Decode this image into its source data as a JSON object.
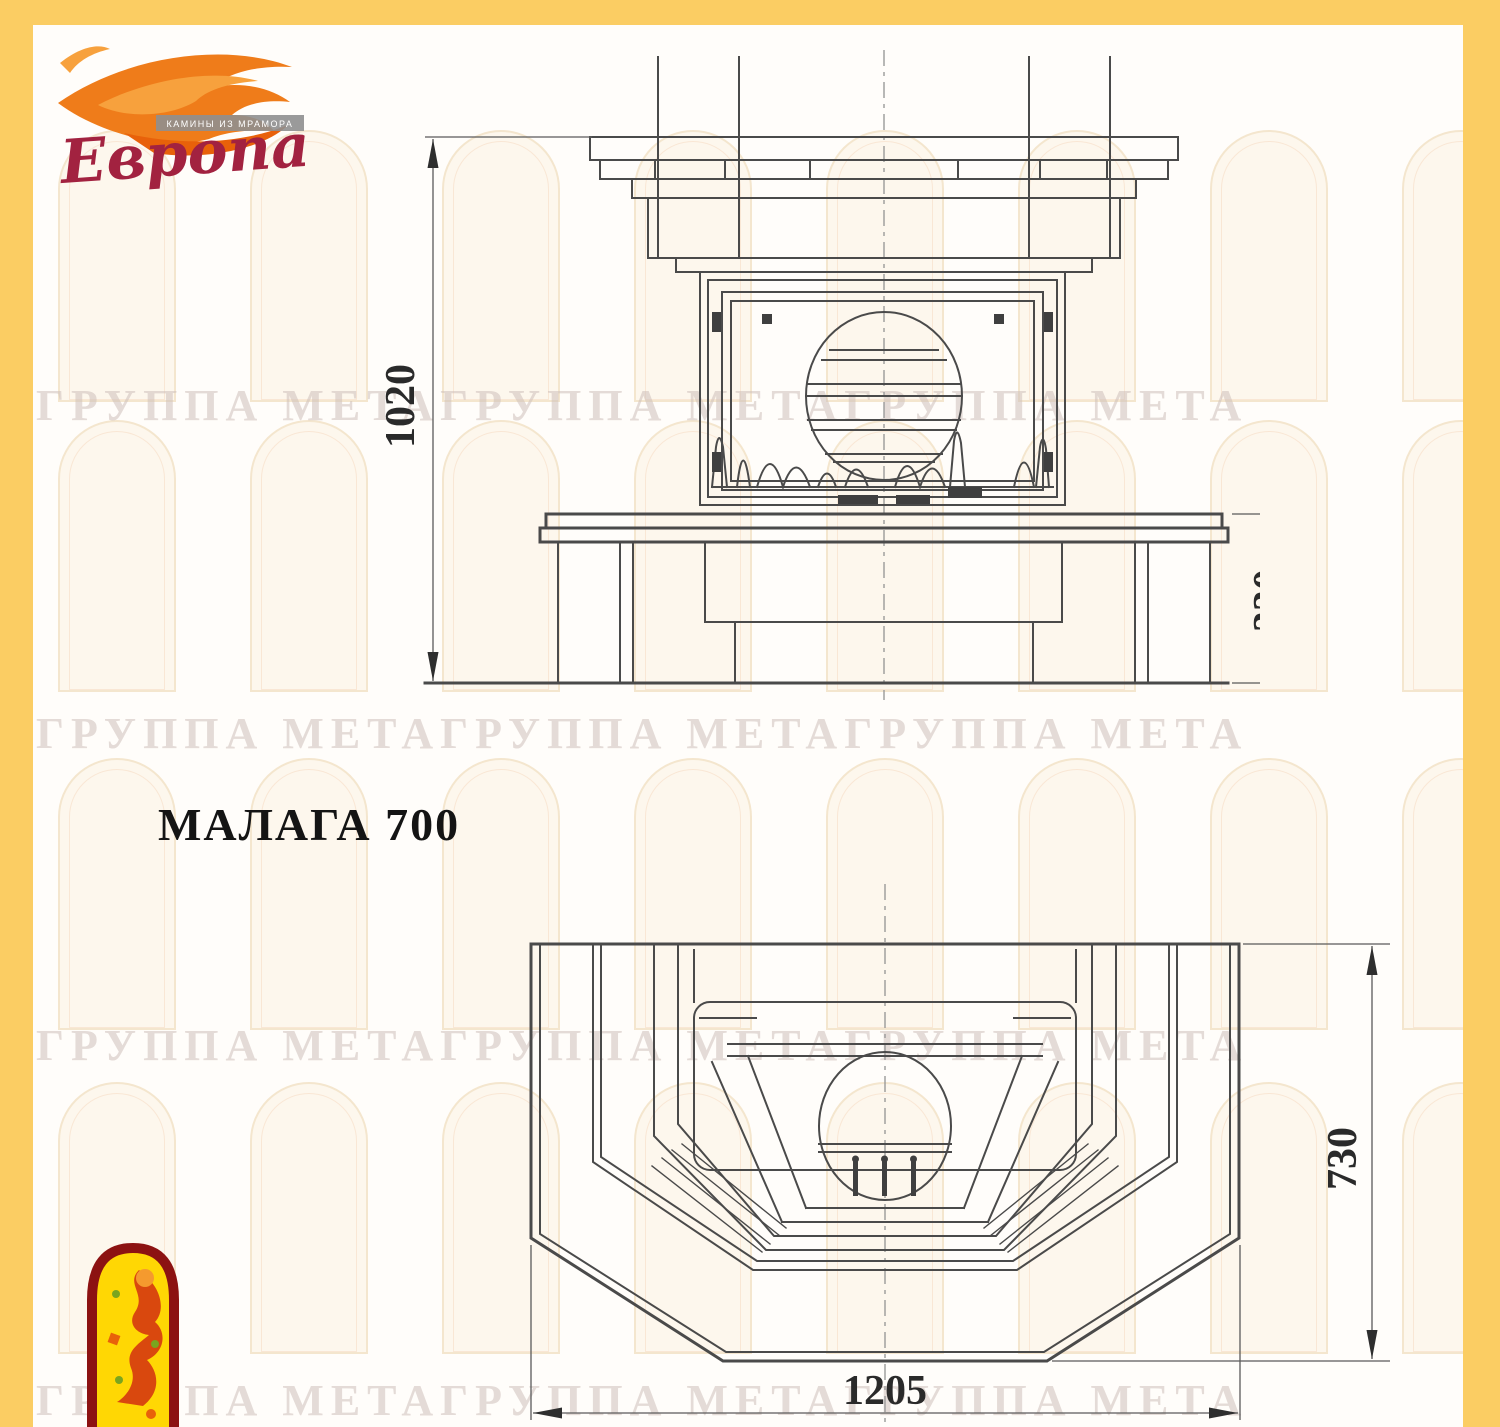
{
  "page": {
    "frame_color": "#fbcd63",
    "paper_color": "#fffdfa",
    "line_color": "#4a4a4a"
  },
  "brand": {
    "name": "Европа",
    "tagline": "КАМИНЫ ИЗ МРАМОРА",
    "flame_color": "#ef7c1a",
    "flame_light": "#f7a13d",
    "flame_deep": "#e8610a",
    "name_color": "#a22240"
  },
  "title": {
    "label": "МАЛАГА 700"
  },
  "front_view": {
    "description": "fireplace front elevation drawing",
    "height_label": "1020",
    "base_label": "330"
  },
  "plan_view": {
    "description": "fireplace top plan drawing",
    "depth_label": "730",
    "width_label": "1205"
  },
  "watermark": {
    "text": "ГРУППА МЕТАГРУППА МЕТАГРУППА МЕТА",
    "text_rows": [
      380,
      708,
      1020,
      1375
    ],
    "arches": {
      "rows": [
        130,
        420,
        758,
        1082
      ],
      "start": 58,
      "step": 192,
      "count": 8,
      "width": 118,
      "height": 272
    }
  },
  "emblem": {
    "name": "firebird-arch-emblem",
    "border_color": "#8c1212",
    "fill_color": "#ffd704",
    "figure_color": "#d9480e"
  }
}
